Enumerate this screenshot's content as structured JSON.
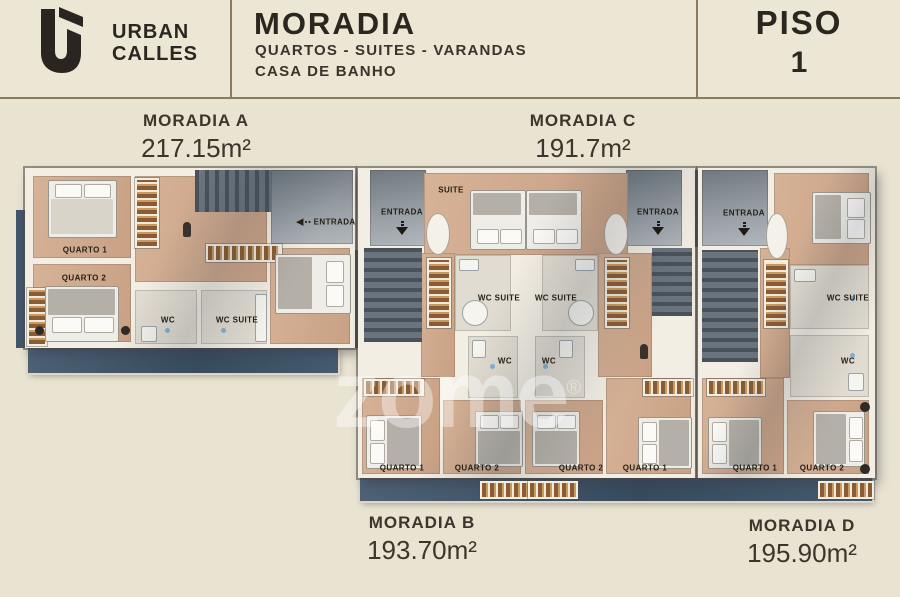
{
  "header": {
    "brand_line1": "URBAN",
    "brand_line2": "CALLES",
    "title": "MORADIA",
    "subtitle1": "QUARTOS - SUITES - VARANDAS",
    "subtitle2": "CASA DE BANHO",
    "piso_label": "PISO",
    "piso_number": "1"
  },
  "units": {
    "a": {
      "name": "MORADIA A",
      "area": "217.15m²"
    },
    "b": {
      "name": "MORADIA B",
      "area": "193.70m²"
    },
    "c": {
      "name": "MORADIA C",
      "area": "191.7m²"
    },
    "d": {
      "name": "MORADIA D",
      "area": "195.90m²"
    }
  },
  "rooms": {
    "quarto1": "QUARTO 1",
    "quarto2": "QUARTO 2",
    "wc": "WC",
    "wc_suite": "WC SUITE",
    "suite": "SUITE",
    "entrada": "ENTRADA"
  },
  "icons": {
    "entrada_arrow_left": "◀",
    "entrada_dots": "••"
  },
  "watermark": {
    "text": "zome",
    "reg": "®"
  },
  "colors": {
    "bg": "#e9e3d1",
    "header_bg": "#ece6d5",
    "line": "#8b7c5d",
    "ink": "#2b2620",
    "label_ink": "#3b352b",
    "wood": "#c9a184",
    "wood_light": "#d6b296",
    "wall": "#f3eee3",
    "slate": "#44566b",
    "slate_dark": "#374a5e",
    "stair_dark": "#49525b",
    "stair_light": "#6a747e",
    "bath": "#e1dcd1",
    "closet": "#8a5c33",
    "closet_gold": "#c89a63",
    "bed_white": "#efede8",
    "bed_gray": "#b5b0a7",
    "room_ink": "#262118"
  }
}
